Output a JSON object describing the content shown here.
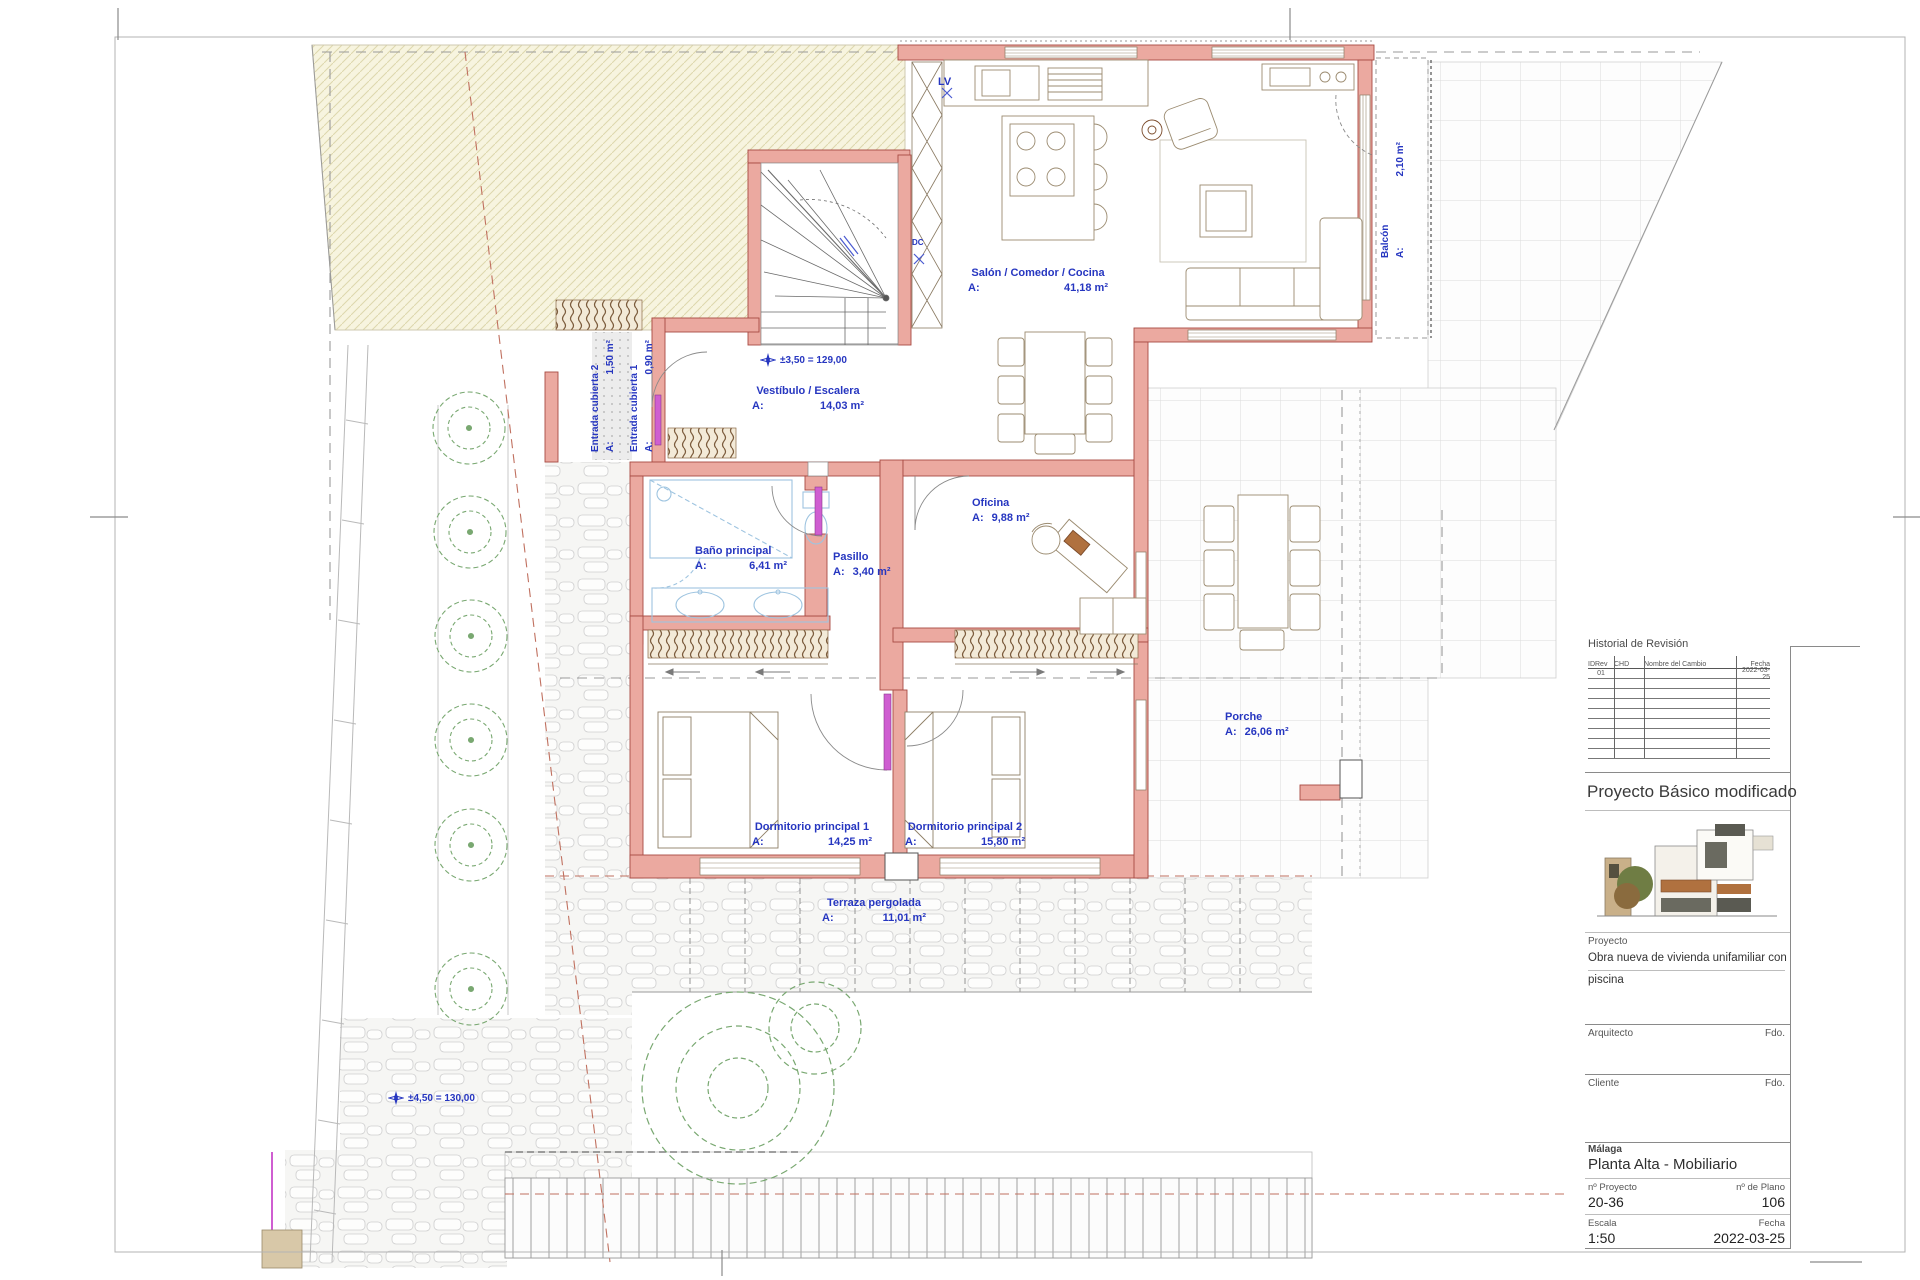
{
  "colors": {
    "label_blue": "#2636c0",
    "wall_fill": "#eba9a0",
    "wall_edge": "#a84a42",
    "door_magenta": "#cf5ed1",
    "fixture_blue": "#9ec4e0",
    "tree_green": "#79a871",
    "hatch_cream": "#f7f4df"
  },
  "plan": {
    "area_prefix": "A:",
    "rooms": {
      "salon": {
        "name": "Salón / Comedor / Cocina",
        "area": "41,18 m²"
      },
      "vestibulo": {
        "name": "Vestíbulo / Escalera",
        "area": "14,03 m²"
      },
      "oficina": {
        "name": "Oficina",
        "area": "9,88 m²"
      },
      "bano": {
        "name": "Baño principal",
        "area": "6,41 m²"
      },
      "pasillo": {
        "name": "Pasillo",
        "area": "3,40 m²"
      },
      "dorm1": {
        "name": "Dormitorio principal 1",
        "area": "14,25 m²"
      },
      "dorm2": {
        "name": "Dormitorio principal 2",
        "area": "15,80 m²"
      },
      "terraza": {
        "name": "Terraza pergolada",
        "area": "11,01 m²"
      },
      "porche": {
        "name": "Porche",
        "area": "26,06 m²"
      },
      "balcon": {
        "name": "Balcón",
        "area": "2,10 m²"
      },
      "entrada2": {
        "name": "Entrada cubierta 2",
        "area": "1,50 m²"
      },
      "entrada1": {
        "name": "Entrada cubierta 1",
        "area": "0,90 m²"
      }
    },
    "annotations": {
      "lv": "LV",
      "dc": "DC",
      "level_upper": "±3,50 = 129,00",
      "level_lower": "±4,50 = 130,00"
    }
  },
  "titleblock": {
    "revision_title": "Historial de Revisión",
    "col_idrev": "IDRev",
    "col_chd": "CHD",
    "col_cambio": "Nombre del Cambio",
    "col_fecha": "Fecha",
    "row1_id": "01",
    "row1_fecha": "2022-03-25",
    "status": "Proyecto Básico modificado",
    "proyecto_label": "Proyecto",
    "proyecto_line1": "Obra nueva de vivienda unifamiliar con",
    "proyecto_line2": "piscina",
    "arquitecto_label": "Arquitecto",
    "arquitecto_fdo": "Fdo.",
    "cliente_label": "Cliente",
    "cliente_fdo": "Fdo.",
    "city": "Málaga",
    "plan_title": "Planta Alta - Mobiliario",
    "nproyecto_label": "nº Proyecto",
    "nproyecto": "20-36",
    "nplano_label": "nº de Plano",
    "nplano": "106",
    "escala_label": "Escala",
    "escala": "1:50",
    "fecha_label": "Fecha",
    "fecha": "2022-03-25"
  }
}
